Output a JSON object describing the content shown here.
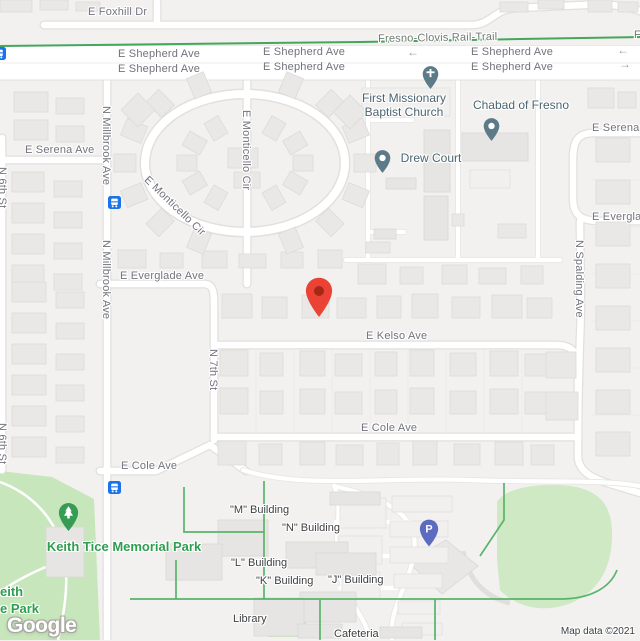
{
  "map": {
    "logo": "Google",
    "attribution": "Map data ©2021",
    "colors": {
      "land": "#F2F1EF",
      "road": "#FFFFFF",
      "casing": "#E1E0DE",
      "park": "#C8E6BC",
      "ballfield": "#CFE9C5",
      "trail_green": "#43A75C",
      "path_green": "#58B46A",
      "street_label": "#72727E",
      "poi_label": "#4B6471",
      "campus_label": "#3F4043",
      "park_label": "#2E9E4F",
      "poi_pin": "#5D7A89",
      "tree_pin": "#359B55",
      "parking_pin": "#5C6BC0",
      "transit_blue": "#1A73E8",
      "marker_red": "#EA4335",
      "marker_red_dark": "#A52714",
      "arrow_gray": "#9AA0A6"
    },
    "street_labels": [
      {
        "id": "foxhill",
        "text": "E Foxhill Dr",
        "x": 88,
        "y": 6
      },
      {
        "id": "rail-trail",
        "text": "Fresno-Clovis Rail-Trail",
        "x": 378,
        "y": 33,
        "cls": "trail",
        "rot": -1
      },
      {
        "id": "rail-trail-2",
        "text": "Fresno-Clovis Rail-Trail",
        "x": 634,
        "y": 29,
        "cls": "trail"
      },
      {
        "id": "shepherd-w-1",
        "text": "E Shepherd Ave",
        "x": 118,
        "y": 48
      },
      {
        "id": "shepherd-w-2",
        "text": "E Shepherd Ave",
        "x": 118,
        "y": 63
      },
      {
        "id": "shepherd-c-1",
        "text": "E Shepherd Ave",
        "x": 263,
        "y": 46
      },
      {
        "id": "shepherd-c-2",
        "text": "E Shepherd Ave",
        "x": 263,
        "y": 61
      },
      {
        "id": "shepherd-e-1",
        "text": "E Shepherd Ave",
        "x": 471,
        "y": 46
      },
      {
        "id": "shepherd-e-2",
        "text": "E Shepherd Ave",
        "x": 471,
        "y": 61
      },
      {
        "id": "serena-w",
        "text": "E Serena Ave",
        "x": 25,
        "y": 144
      },
      {
        "id": "serena-e",
        "text": "E Serena Ave",
        "x": 592,
        "y": 122
      },
      {
        "id": "n6th-1",
        "text": "N 6th St",
        "x": 8,
        "y": 167,
        "rot": 90
      },
      {
        "id": "n6th-2",
        "text": "N 6th St",
        "x": 8,
        "y": 423,
        "rot": 90
      },
      {
        "id": "millbrook-1",
        "text": "N Millbrook Ave",
        "x": 112,
        "y": 106,
        "rot": 90
      },
      {
        "id": "millbrook-2",
        "text": "N Millbrook Ave",
        "x": 112,
        "y": 240,
        "rot": 90
      },
      {
        "id": "monticello-v",
        "text": "E Monticello Cir",
        "x": 252,
        "y": 110,
        "rot": 90
      },
      {
        "id": "monticello-d",
        "text": "E Monticello Cir",
        "x": 150,
        "y": 174,
        "rot": 44
      },
      {
        "id": "everglade-w",
        "text": "E Everglade Ave",
        "x": 120,
        "y": 270
      },
      {
        "id": "everglade-e",
        "text": "E Everglade Ave",
        "x": 592,
        "y": 211
      },
      {
        "id": "kelso",
        "text": "E Kelso Ave",
        "x": 366,
        "y": 330
      },
      {
        "id": "n7th",
        "text": "N 7th St",
        "x": 219,
        "y": 349,
        "rot": 90
      },
      {
        "id": "spalding",
        "text": "N Spalding Ave",
        "x": 585,
        "y": 240,
        "rot": 90
      },
      {
        "id": "cole-e",
        "text": "E Cole Ave",
        "x": 361,
        "y": 422
      },
      {
        "id": "cole-w",
        "text": "E Cole Ave",
        "x": 121,
        "y": 460
      }
    ],
    "arrows": [
      {
        "dir": "left",
        "x": 407,
        "y": 47
      },
      {
        "dir": "left",
        "x": 617,
        "y": 45
      },
      {
        "dir": "right",
        "x": 619,
        "y": 59
      }
    ],
    "pois": [
      {
        "id": "first-missionary",
        "lines": [
          "First Missionary",
          "Baptist Church"
        ],
        "cx": 404,
        "y": 91,
        "cls": "poi"
      },
      {
        "id": "chabad",
        "lines": [
          "Chabad of Fresno"
        ],
        "cx": 521,
        "y": 98,
        "cls": "poi"
      },
      {
        "id": "drew-court",
        "lines": [
          "Drew Court"
        ],
        "cx": 431,
        "y": 151,
        "cls": "poi"
      },
      {
        "id": "keith-tice-park",
        "lines": [
          "Keith Tice Memorial Park"
        ],
        "cx": 124,
        "y": 538,
        "cls": "park"
      },
      {
        "id": "park-clipped",
        "lines": [
          "eith",
          "e Park"
        ],
        "x": 0,
        "y": 583,
        "cls": "park"
      },
      {
        "id": "m-building",
        "lines": [
          "\"M\" Building"
        ],
        "x": 230,
        "y": 504,
        "cls": "campus"
      },
      {
        "id": "n-building",
        "lines": [
          "\"N\" Building"
        ],
        "x": 282,
        "y": 522,
        "cls": "campus"
      },
      {
        "id": "l-building",
        "lines": [
          "\"L\" Building"
        ],
        "x": 231,
        "y": 557,
        "cls": "campus"
      },
      {
        "id": "k-building",
        "lines": [
          "\"K\" Building"
        ],
        "x": 256,
        "y": 575,
        "cls": "campus"
      },
      {
        "id": "j-building",
        "lines": [
          "\"J\" Building"
        ],
        "x": 328,
        "y": 574,
        "cls": "campus"
      },
      {
        "id": "library",
        "lines": [
          "Library"
        ],
        "x": 233,
        "y": 613,
        "cls": "campus"
      },
      {
        "id": "cafeteria",
        "lines": [
          "Cafeteria"
        ],
        "x": 334,
        "y": 628,
        "cls": "campus"
      }
    ],
    "pins": [
      {
        "id": "church-pin",
        "type": "cross",
        "x": 430,
        "y": 65
      },
      {
        "id": "chabad-pin",
        "type": "dot",
        "x": 491,
        "y": 117
      },
      {
        "id": "drew-pin",
        "type": "dot",
        "x": 382,
        "y": 149
      },
      {
        "id": "park-tree-pin",
        "type": "tree",
        "x": 68,
        "y": 501
      },
      {
        "id": "parking-pin",
        "type": "parking",
        "x": 429,
        "y": 518
      },
      {
        "id": "location-marker",
        "type": "marker",
        "x": 319,
        "y": 277
      }
    ],
    "transit_stops": [
      {
        "x": 108,
        "y": 196
      },
      {
        "x": 108,
        "y": 481
      },
      {
        "x": -7,
        "y": 47
      }
    ]
  }
}
